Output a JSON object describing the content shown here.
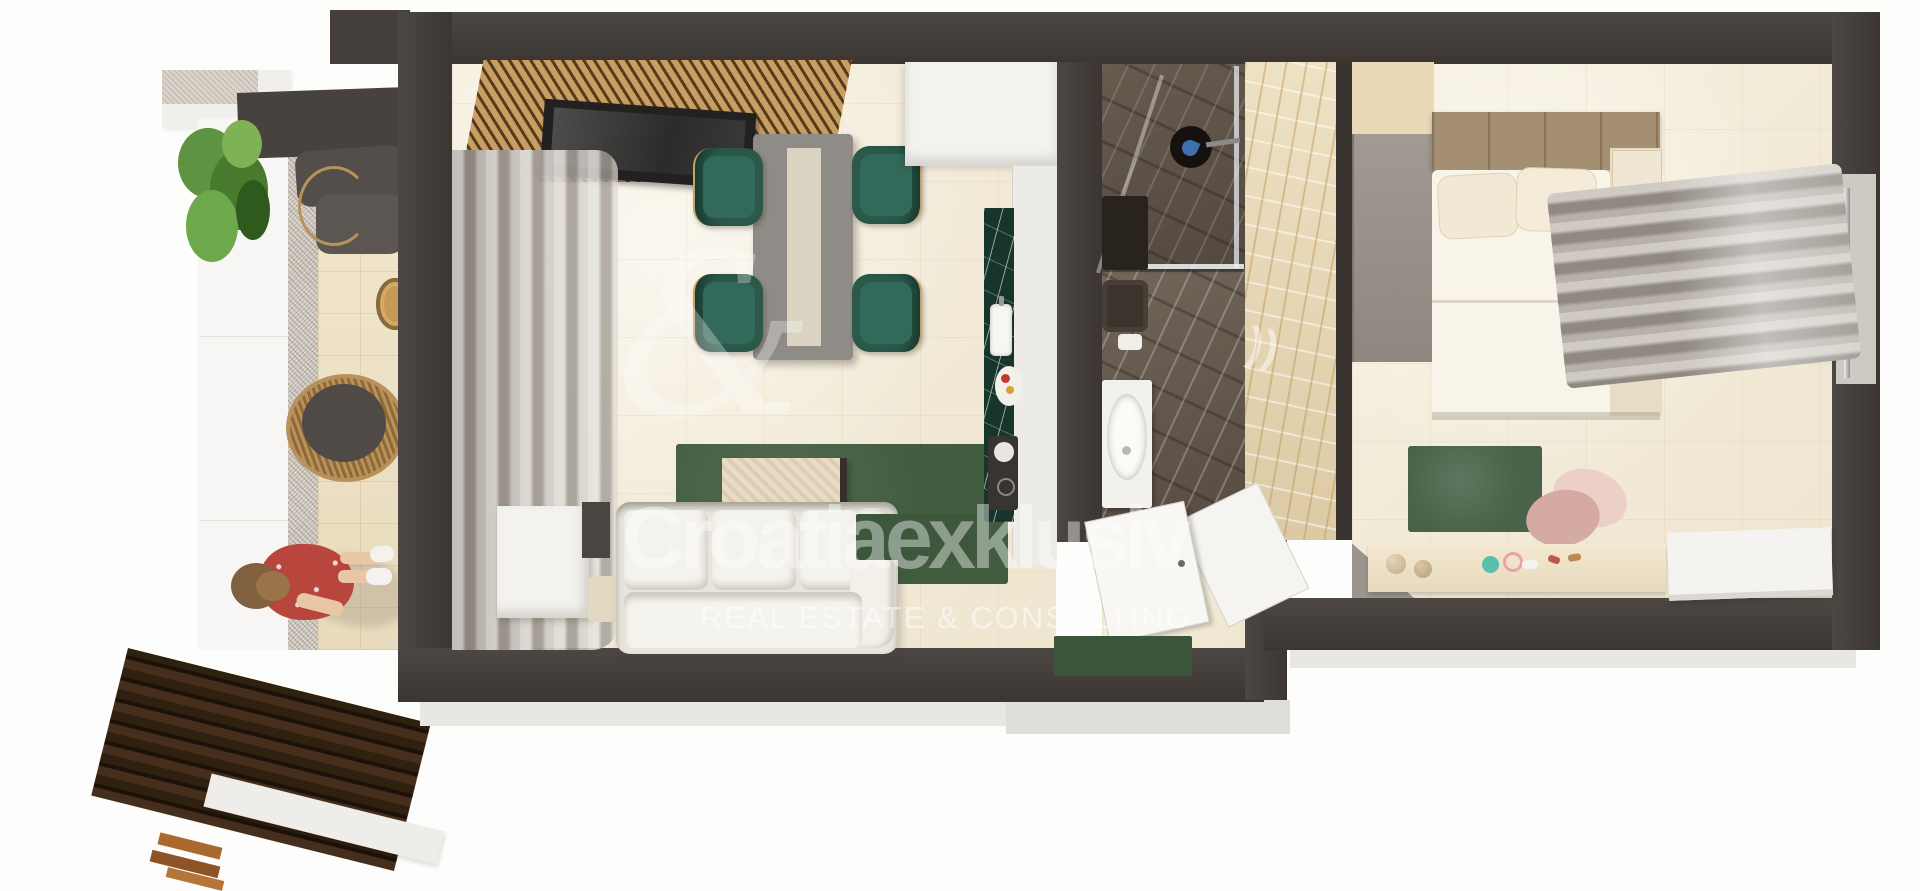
{
  "watermark": {
    "logo_glyph": "&",
    "echo_arcs": "))",
    "brand": "Croatiaexklusiv",
    "tagline": "REAL ESTATE & CONSULTING"
  },
  "palette": {
    "wall_charcoal": "#3c3633",
    "floor_tile_cream": "#f2ecdb",
    "chair_green": "#2b5a4b",
    "rug_green": "#415c3f",
    "kitchen_marble_green": "#17352b",
    "bath_marble_dark": "#6a5e53",
    "bath_marble_gold": "#e5d5b7",
    "wood_slat_tan": "#c89f63",
    "deck_wood_brown": "#30200f",
    "curtain_gray": "#aaa39b",
    "sofa_white": "#f2f0e9",
    "pouf_pink": "#d5aaa2",
    "dress_red": "#b8463c",
    "plant_green": "#5e9342"
  },
  "scene": {
    "view": "top-down 3D apartment floor plan render",
    "rooms": [
      {
        "name": "balcony",
        "items": [
          "planter",
          "hanging-rattan-chair",
          "rattan-egg-chair",
          "round-side-table",
          "person-in-red-dress",
          "wood-slat-deck"
        ]
      },
      {
        "name": "living-room",
        "items": [
          "wood-slat-tv-wall",
          "tv",
          "gray-curtains",
          "dining-table-with-runner",
          "four-green-armchairs",
          "green-area-rug",
          "coffee-table",
          "white-sofa",
          "side-table"
        ]
      },
      {
        "name": "kitchen",
        "items": [
          "tall-white-cabinets",
          "green-marble-counter",
          "sink",
          "fruit-plate",
          "cooktop",
          "green-mat"
        ]
      },
      {
        "name": "bathroom",
        "items": [
          "walk-in-shower",
          "black-rain-shower-head",
          "wc",
          "white-vanity-sink"
        ]
      },
      {
        "name": "entry-hall",
        "items": [
          "white-entry-door",
          "green-doormat"
        ]
      },
      {
        "name": "bedroom",
        "items": [
          "wardrobe",
          "double-bed",
          "two-pillows",
          "nightstand",
          "wavy-gray-curtains",
          "green-rug",
          "pink-chair",
          "dresser-with-cosmetics",
          "white-desk"
        ]
      }
    ]
  }
}
